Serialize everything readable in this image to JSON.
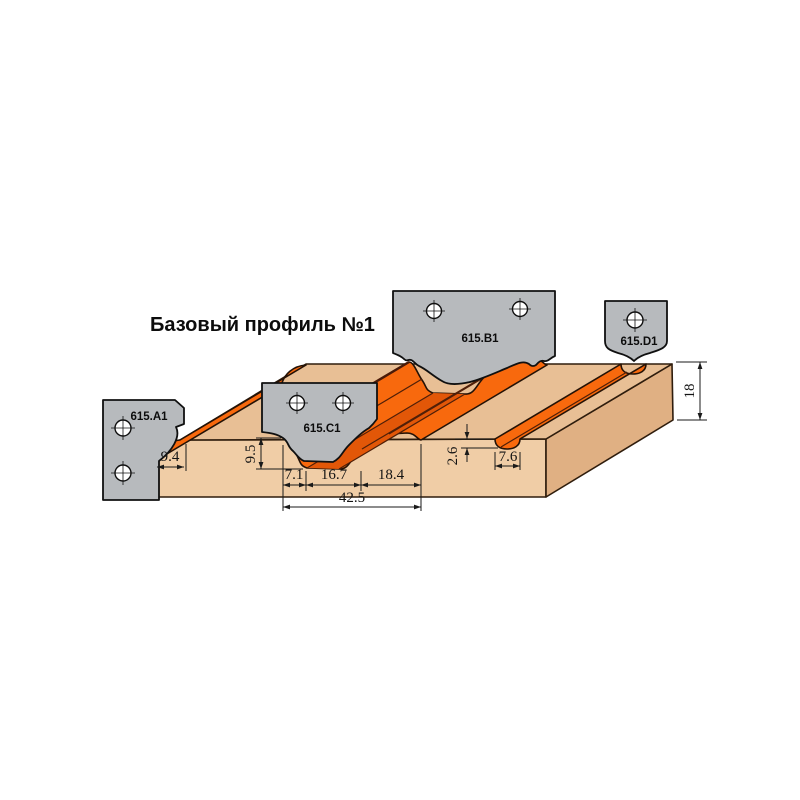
{
  "diagram": {
    "title": "Базовый профиль №1",
    "knives": [
      {
        "id": "a1",
        "label": "615.A1"
      },
      {
        "id": "b1",
        "label": "615.B1"
      },
      {
        "id": "c1",
        "label": "615.C1"
      },
      {
        "id": "d1",
        "label": "615.D1"
      }
    ],
    "dimensions_mm": {
      "left_edge_width": "9.4",
      "profile_depth": "9.5",
      "segment_1": "7.1",
      "segment_2": "16.7",
      "segment_3": "18.4",
      "profile_total_width": "42.5",
      "groove_depth": "2.6",
      "groove_width": "7.6",
      "board_thickness": "18"
    },
    "colors": {
      "background": "#ffffff",
      "plate_gray": "#b7babd",
      "wood_front": "#f0cda6",
      "wood_top": "#e8bf95",
      "wood_side": "#e0b083",
      "profile_orange": "#f8690d",
      "outline_dark": "#241206"
    }
  }
}
